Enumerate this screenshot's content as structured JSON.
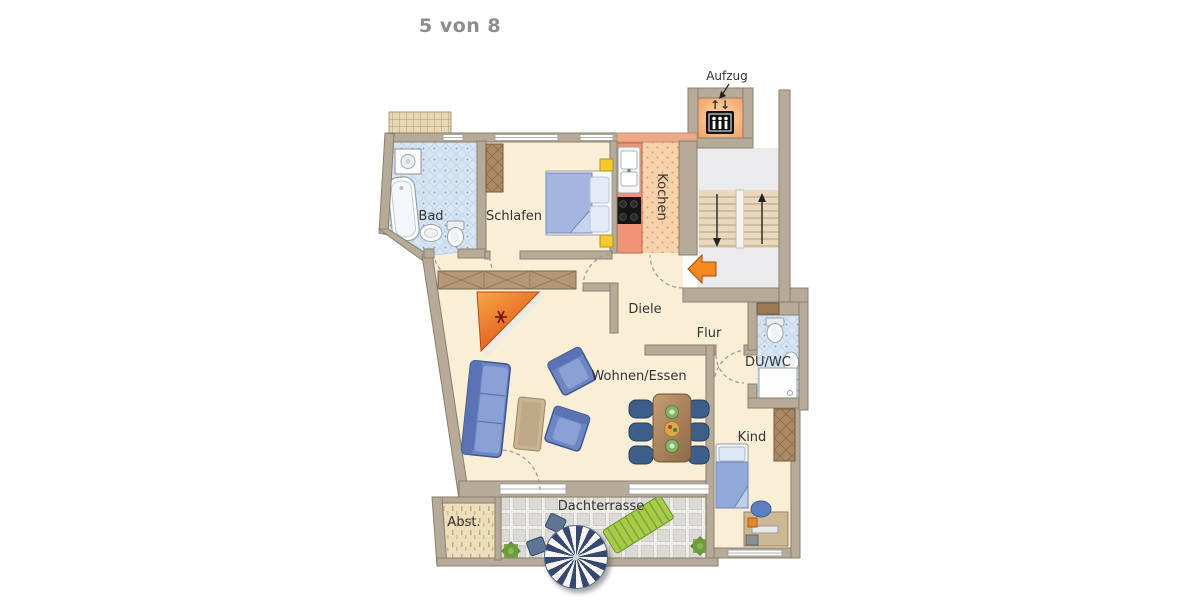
{
  "page": {
    "indicator": "5 von 8"
  },
  "floorplan": {
    "labels": {
      "elevator": "Aufzug",
      "bath": "Bad",
      "bedroom": "Schlafen",
      "kitchen": "Kochen",
      "hallway": "Diele",
      "corridor": "Flur",
      "shower_wc": "DU/WC",
      "living_dining": "Wohnen/Essen",
      "child_room": "Kind",
      "roof_terrace": "Dachterrasse",
      "storage": "Abst."
    },
    "icons": {
      "elevator_arrows": "↑↓",
      "elevator_cabin": "elevator-people-icon",
      "entrance_arrow": "entrance-arrow-icon",
      "stair_up_arrow": "up",
      "stair_down_arrow": "down"
    },
    "colors": {
      "wall": "#b6ab98",
      "floor_cream": "#f9efd6",
      "bath_tile": "#d8e6f3",
      "kitchen_counter": "#ee9578",
      "kitchen_floor": "#f7d2ab",
      "stair_floor": "#ebebee",
      "stairs": "#ead8bc",
      "terrace_tile": "#dddcd7",
      "storage_floor": "#eedfbc",
      "accent_orange": "#f5891f",
      "fireplace_orange": "#e86a20",
      "furniture_blue": "#6d86c4",
      "parasol_navy": "#37476f",
      "lounger_green": "#a9cc48"
    }
  }
}
